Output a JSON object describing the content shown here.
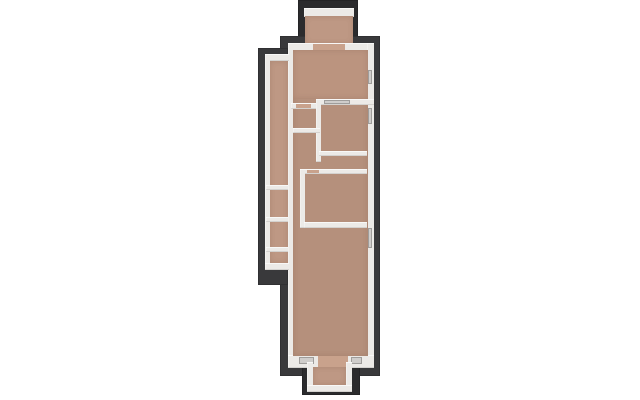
{
  "scene": {
    "description": "top-down 3d render of a narrow apartment floor plan on white background",
    "background": "#ffffff",
    "colors": {
      "dark": "#39393b",
      "dark2": "#2b2b2d",
      "wall": "#eceae7",
      "floor": "#b5907c",
      "floor2": "#be9884",
      "floor3": "#bb947f",
      "door": "#c9a28c",
      "glass": "#cfcdcb"
    },
    "rects": [
      {
        "name": "shadow-top-balcony",
        "c": "dark2",
        "x": 298,
        "y": 0,
        "w": 60,
        "h": 50
      },
      {
        "name": "shadow-main-body",
        "c": "dark",
        "x": 280,
        "y": 36,
        "w": 100,
        "h": 340
      },
      {
        "name": "shadow-left-wing",
        "c": "dark",
        "x": 258,
        "y": 48,
        "w": 30,
        "h": 237
      },
      {
        "name": "shadow-bottom-balcony",
        "c": "dark2",
        "x": 302,
        "y": 356,
        "w": 58,
        "h": 39
      },
      {
        "name": "top-balcony-railing",
        "c": "wall",
        "x": 304,
        "y": 8,
        "w": 50,
        "h": 9
      },
      {
        "name": "top-balcony-floor",
        "c": "floor2",
        "x": 305,
        "y": 16,
        "w": 48,
        "h": 28
      },
      {
        "name": "outer-wall-top",
        "c": "wall",
        "x": 288,
        "y": 43,
        "w": 86,
        "h": 8
      },
      {
        "name": "outer-wall-left",
        "c": "wall",
        "x": 288,
        "y": 43,
        "w": 6,
        "h": 319
      },
      {
        "name": "outer-wall-right",
        "c": "wall",
        "x": 367,
        "y": 43,
        "w": 7,
        "h": 319
      },
      {
        "name": "outer-wall-bottom",
        "c": "wall",
        "x": 288,
        "y": 355,
        "w": 86,
        "h": 13
      },
      {
        "name": "main-floor",
        "c": "floor",
        "x": 293,
        "y": 50,
        "w": 75,
        "h": 306
      },
      {
        "name": "bedroom-top-floor",
        "c": "floor3",
        "x": 293,
        "y": 50,
        "w": 75,
        "h": 49
      },
      {
        "name": "side-balcony-top-wall",
        "c": "wall",
        "x": 265,
        "y": 54,
        "w": 24,
        "h": 7
      },
      {
        "name": "side-balcony-railing",
        "c": "wall",
        "x": 265,
        "y": 54,
        "w": 5,
        "h": 216
      },
      {
        "name": "side-balcony-floor",
        "c": "floor2",
        "x": 270,
        "y": 61,
        "w": 18,
        "h": 202
      },
      {
        "name": "side-balcony-divider-1",
        "c": "wall",
        "x": 266,
        "y": 185,
        "w": 22,
        "h": 5
      },
      {
        "name": "side-balcony-divider-2",
        "c": "wall",
        "x": 266,
        "y": 217,
        "w": 22,
        "h": 5
      },
      {
        "name": "side-balcony-divider-3",
        "c": "wall",
        "x": 266,
        "y": 247,
        "w": 22,
        "h": 5
      },
      {
        "name": "side-balcony-bottom-wall",
        "c": "wall",
        "x": 265,
        "y": 263,
        "w": 24,
        "h": 7
      },
      {
        "name": "inner-wall-h1-right",
        "c": "wall",
        "x": 316,
        "y": 99,
        "w": 58,
        "h": 6
      },
      {
        "name": "inner-wall-h1-left",
        "c": "wall",
        "x": 291,
        "y": 103,
        "w": 29,
        "h": 6
      },
      {
        "name": "inner-wall-v1",
        "c": "wall",
        "x": 316,
        "y": 99,
        "w": 5,
        "h": 63
      },
      {
        "name": "inner-wall-h2",
        "c": "wall",
        "x": 293,
        "y": 128,
        "w": 27,
        "h": 5
      },
      {
        "name": "inner-wall-h3",
        "c": "wall",
        "x": 319,
        "y": 151,
        "w": 48,
        "h": 5
      },
      {
        "name": "inner-wall-h4",
        "c": "wall",
        "x": 304,
        "y": 169,
        "w": 63,
        "h": 5
      },
      {
        "name": "inner-wall-v2",
        "c": "wall",
        "x": 300,
        "y": 169,
        "w": 5,
        "h": 59
      },
      {
        "name": "inner-wall-h5",
        "c": "wall",
        "x": 304,
        "y": 222,
        "w": 63,
        "h": 6
      },
      {
        "name": "door-top-balcony",
        "c": "door",
        "x": 313,
        "y": 44,
        "w": 32,
        "h": 6
      },
      {
        "name": "door-hall-top",
        "c": "door",
        "x": 296,
        "y": 104,
        "w": 15,
        "h": 4
      },
      {
        "name": "glass-door-bedroom",
        "c": "glass",
        "x": 324,
        "y": 100,
        "w": 26,
        "h": 4
      },
      {
        "name": "door-mid-room",
        "c": "door",
        "x": 307,
        "y": 170,
        "w": 12,
        "h": 3
      },
      {
        "name": "window-right-1",
        "c": "glass",
        "x": 368,
        "y": 70,
        "w": 4,
        "h": 14
      },
      {
        "name": "window-right-2",
        "c": "glass",
        "x": 368,
        "y": 108,
        "w": 4,
        "h": 16
      },
      {
        "name": "window-right-3",
        "c": "glass",
        "x": 368,
        "y": 228,
        "w": 4,
        "h": 20
      },
      {
        "name": "window-bottom-left",
        "c": "glass",
        "x": 299,
        "y": 357,
        "w": 15,
        "h": 7
      },
      {
        "name": "door-bottom-balcony",
        "c": "door",
        "x": 318,
        "y": 356,
        "w": 30,
        "h": 12
      },
      {
        "name": "window-bottom-right",
        "c": "glass",
        "x": 351,
        "y": 357,
        "w": 11,
        "h": 7
      },
      {
        "name": "bottom-balcony-wall-left",
        "c": "wall",
        "x": 307,
        "y": 362,
        "w": 6,
        "h": 29
      },
      {
        "name": "bottom-balcony-wall-right",
        "c": "wall",
        "x": 346,
        "y": 362,
        "w": 6,
        "h": 29
      },
      {
        "name": "bottom-balcony-wall-front",
        "c": "wall",
        "x": 307,
        "y": 385,
        "w": 45,
        "h": 7
      },
      {
        "name": "bottom-balcony-floor",
        "c": "floor2",
        "x": 313,
        "y": 367,
        "w": 33,
        "h": 18
      }
    ]
  }
}
